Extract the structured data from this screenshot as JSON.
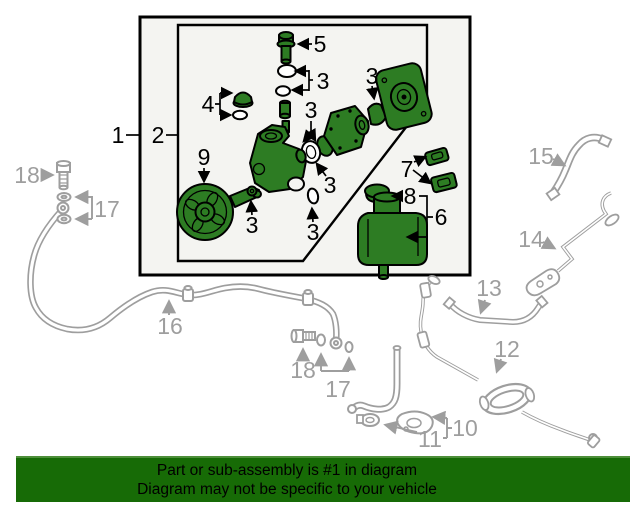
{
  "banner": {
    "line1": "Part or sub-assembly is #1 in diagram",
    "line2": "Diagram may not be specific to your vehicle",
    "background": "#176b06",
    "text_color": "#000000"
  },
  "callouts": {
    "n1": "1",
    "n2": "2",
    "n3": "3",
    "n4": "4",
    "n5": "5",
    "n6": "6",
    "n7": "7",
    "n8": "8",
    "n9": "9",
    "n10": "10",
    "n11": "11",
    "n12": "12",
    "n13": "13",
    "n14": "14",
    "n15": "15",
    "n16": "16",
    "n17": "17",
    "n18": "18"
  },
  "colors": {
    "part_green": "#2d7c23",
    "hose_gray": "#9e9e9e",
    "label_gray": "#9e9e9e",
    "outline_black": "#000000",
    "box_background": "#f4f4f1",
    "page_background": "#ffffff"
  }
}
